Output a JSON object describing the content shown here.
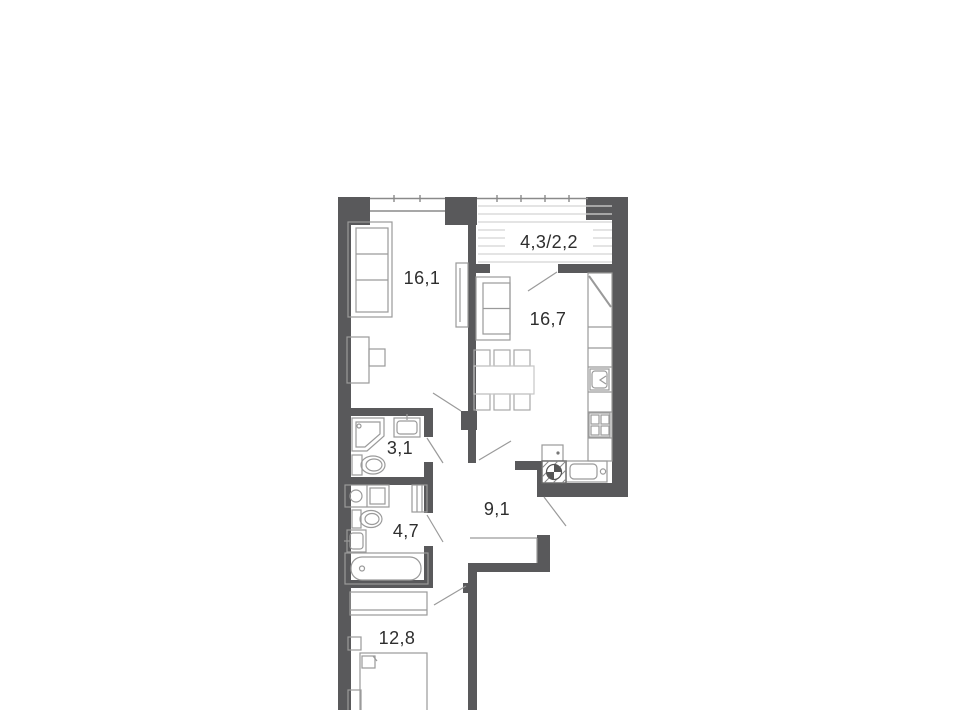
{
  "title": "Apartment floor plan",
  "rooms": {
    "living_room": {
      "label": "16,1"
    },
    "loggia": {
      "label": "4,3/2,2"
    },
    "kitchen": {
      "label": "16,7"
    },
    "wc": {
      "label": "3,1"
    },
    "bathroom": {
      "label": "4,7"
    },
    "hallway": {
      "label": "9,1"
    },
    "bedroom": {
      "label": "12,8"
    }
  },
  "colors": {
    "wall": "#59595b",
    "line": "#9a9a9a",
    "lightline": "#c6c6c6",
    "hatch": "#d4d4d4",
    "window": "#8a8a8a",
    "label": "#2e2e2e",
    "background": "#ffffff"
  }
}
